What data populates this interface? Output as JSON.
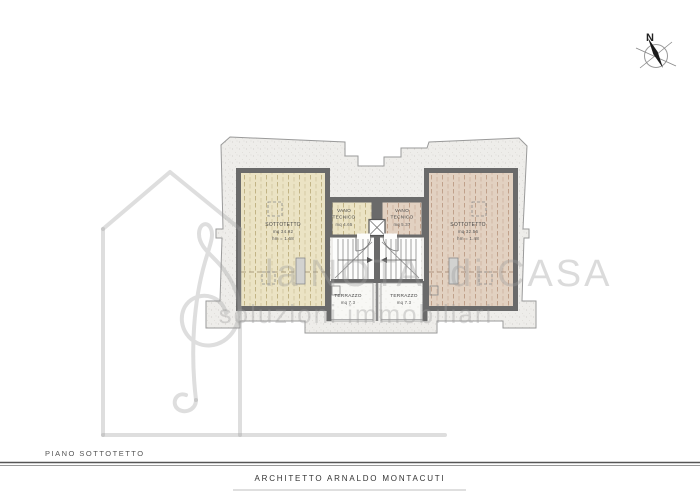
{
  "compass": {
    "north_label": "N"
  },
  "watermark": {
    "word1": "la",
    "word2": "NOTA",
    "word3": "di",
    "word4": "CASA",
    "tagline": "soluzioni immobiliari"
  },
  "rooms": {
    "sottotetto_left": {
      "name": "SOTTOTETTO",
      "area": "mq 34.92",
      "height": "hm = 1.68"
    },
    "sottotetto_right": {
      "name": "SOTTOTETTO",
      "area": "mq 32.56",
      "height": "hm = 1.48"
    },
    "vano_left": {
      "line1": "VANO",
      "line2": "TECNICO",
      "area": "mq 4.65"
    },
    "vano_right": {
      "line1": "VANO",
      "line2": "TECNICO",
      "area": "mq 5.37"
    },
    "terrazzo_left": {
      "name": "TERRAZZO",
      "area": "mq 7.3"
    },
    "terrazzo_right": {
      "name": "TERRAZZO",
      "area": "mq 7.3"
    }
  },
  "footer": {
    "plan_label": "PIANO SOTTOTETTO",
    "architect": "ARCHITETTO ARNALDO MONTACUTI"
  },
  "colors": {
    "wall": "#6a6a6a",
    "room_left_fill": "#ebe3c4",
    "room_right_fill": "#e2d1c1",
    "stipple_background": "#eeedea",
    "watermark_gray": "#c9c9c9",
    "label_text": "#444444"
  }
}
